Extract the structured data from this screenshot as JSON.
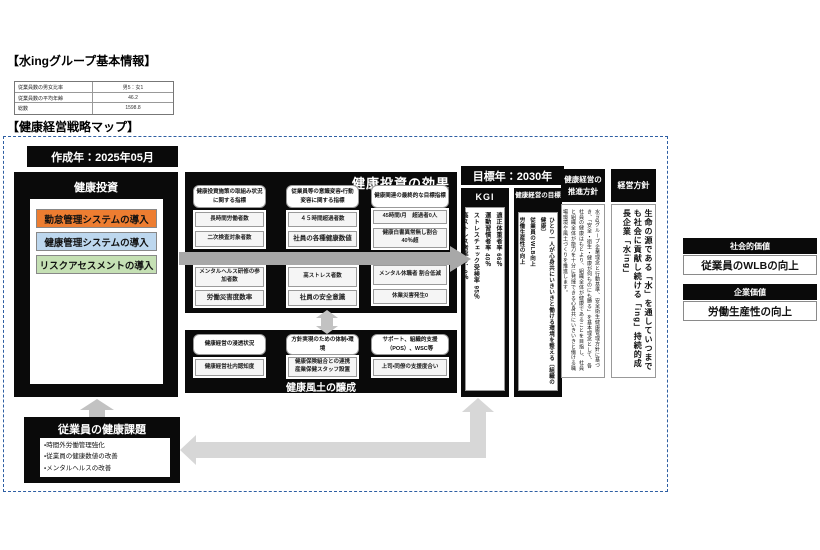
{
  "titles": {
    "basic_info": "【水ingグループ基本情報】",
    "strategy_map": "【健康経営戦略マップ】"
  },
  "info_table": {
    "rows": [
      {
        "label": "従業員数の男女比率",
        "value": "男5：女1"
      },
      {
        "label": "従業員数の平均年齢",
        "value": "46.2"
      },
      {
        "label": "総数",
        "value": "1598.8"
      }
    ]
  },
  "map": {
    "created_label": "作成年：2025年05月",
    "investment": {
      "title": "健康投資",
      "items": [
        {
          "label": "勤怠管理システムの導入",
          "bg": "#ED7D31",
          "border": "#B85C1E"
        },
        {
          "label": "健康管理システムの導入",
          "bg": "#BDD7EE",
          "border": "#8EB4DB"
        },
        {
          "label": "リスクアセスメントの導入",
          "bg": "#C5E0B4",
          "border": "#93BF7E"
        }
      ]
    },
    "effects": {
      "title": "健康投資の効果",
      "columns": [
        {
          "header": "健康投資施策の取組み状況に関する指標",
          "up1": "長時間労働者数",
          "up2": "二次検査対象者数",
          "low1": "メンタルヘルス研修の参加者数",
          "low2": "労働災害度数率"
        },
        {
          "header": "従業員等の意識変容・行動変容に関する指標",
          "up1": "４５時間超過者数",
          "up2": "社員の各種健康数値",
          "low1": "高ストレス者数",
          "low2": "社員の安全意識"
        },
        {
          "header": "健康関連の最終的な目標指標",
          "up1": "45時間/月　超過者0人",
          "up2": "健康白書異常無し割合 40％超",
          "low1": "メンタル休職者 割合低減",
          "low2": "休業災害発生0"
        }
      ]
    },
    "culture": {
      "title": "健康風土の醸成",
      "columns": [
        {
          "header": "健康経営の浸透状況",
          "item": "健康経営社内認知度"
        },
        {
          "header": "方針実現のための体制・環境",
          "item": "健康保険組合との連携 産業保健スタッフ設置"
        },
        {
          "header": "サポート、組織的支援（POS）、WSC等",
          "item": "上司・同僚の支援度合い"
        }
      ]
    },
    "target_year": "目標年：2030年",
    "kgi": {
      "title": "KGI",
      "lines": [
        "適正体重者率 66％",
        "運動習慣者率 40％",
        "ストレスチェック受検率 95％",
        "高ストレス者率 9．0％"
      ]
    },
    "goal": {
      "title": "健康経営の目標",
      "lines": [
        "ひとり一人が心身共にいきいきと働ける環境を整える〔組織の健康〕",
        "従業員のWLB向上",
        "労働生産性の向上"
      ]
    },
    "promotion": {
      "title": "健康経営の推進方針",
      "body": "水ingグループ企業理念と行動基準、安全衛生健康管理方針に基づき、「安全・衛生・健康が何ものにも勝る」を基本理念として、各社員の健康はもとより、組織全体が健康であることを目指し、社員と組織全体が能力を十分に発揮できる心身共にいきいきと働ける職場環境や風土づくりを推進します。"
    },
    "policy": {
      "title": "経営方針",
      "body": "生命の源である「水」を通していつまでも社会に貢献し続ける「ing」持続的成長企業「水ing」"
    },
    "issues": {
      "title": "従業員の健康課題",
      "items": [
        "・時間外労働管理強化",
        "・従業員の健康数値の改善",
        "・メンタルヘルスの改善"
      ]
    }
  },
  "values": {
    "social": {
      "header": "社会的価値",
      "body": "従業員のWLBの向上"
    },
    "corporate": {
      "header": "企業価値",
      "body": "労働生産性の向上"
    }
  },
  "colors": {
    "dashed_border": "#2E5FA3",
    "panel_black": "#0A0A0A",
    "band_gray": "#A8A8A8",
    "arrow_light_gray": "#D7D7D7",
    "arrow_mid_gray": "#C2C2C2"
  }
}
